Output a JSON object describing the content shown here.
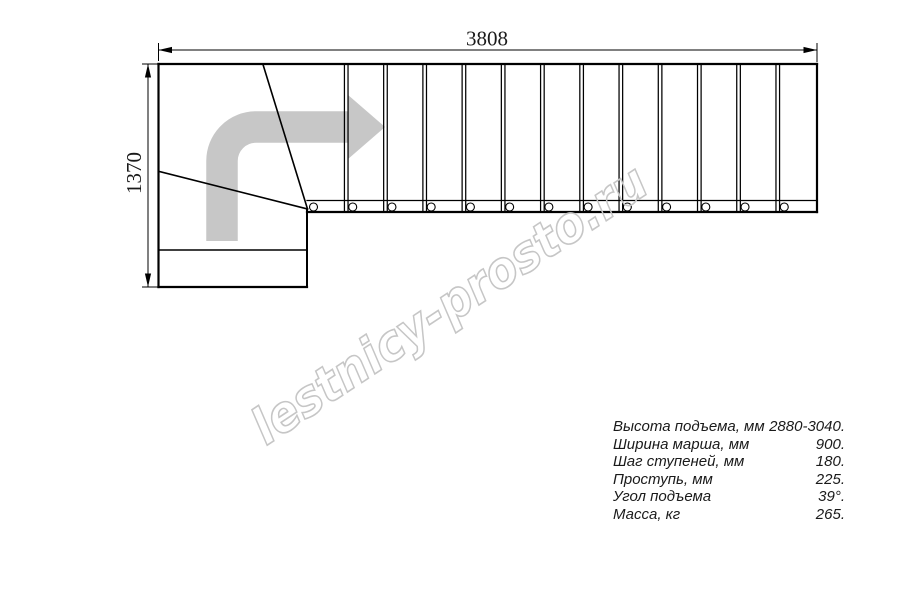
{
  "drawing": {
    "type": "staircase-top-view-plan",
    "dimensions": {
      "top_label": "3808",
      "left_label": "1370"
    },
    "plan": {
      "straight_treads": 13,
      "geometry": {
        "run_x0": 307,
        "run_x1": 817,
        "y_top": 64,
        "y_strip_top": 200.5,
        "y_bottom": 212,
        "tread_line_half_gap": 1.8,
        "circle_r": 4,
        "circle_dx": 6.5,
        "circle_cy": 207
      }
    }
  },
  "watermark": {
    "text": "lestnicy-prosto.ru",
    "color": "#c6c6c6",
    "angle_deg": -33.5
  },
  "icons": {
    "direction_arrow": "direction-arrow-icon"
  },
  "colors": {
    "background": "#ffffff",
    "line": "#000000",
    "arrow_fill": "#c7c7c7",
    "text": "#1a1a1a"
  },
  "specs": {
    "rows": [
      {
        "label": "Высота подъема, мм",
        "value": "2880-3040."
      },
      {
        "label": "Ширина марша, мм",
        "value": "900."
      },
      {
        "label": "Шаг ступеней, мм",
        "value": "180."
      },
      {
        "label": "Проступь, мм",
        "value": "225."
      },
      {
        "label": "Угол подъема",
        "value": "39°."
      },
      {
        "label": "Масса, кг",
        "value": "265."
      }
    ]
  }
}
